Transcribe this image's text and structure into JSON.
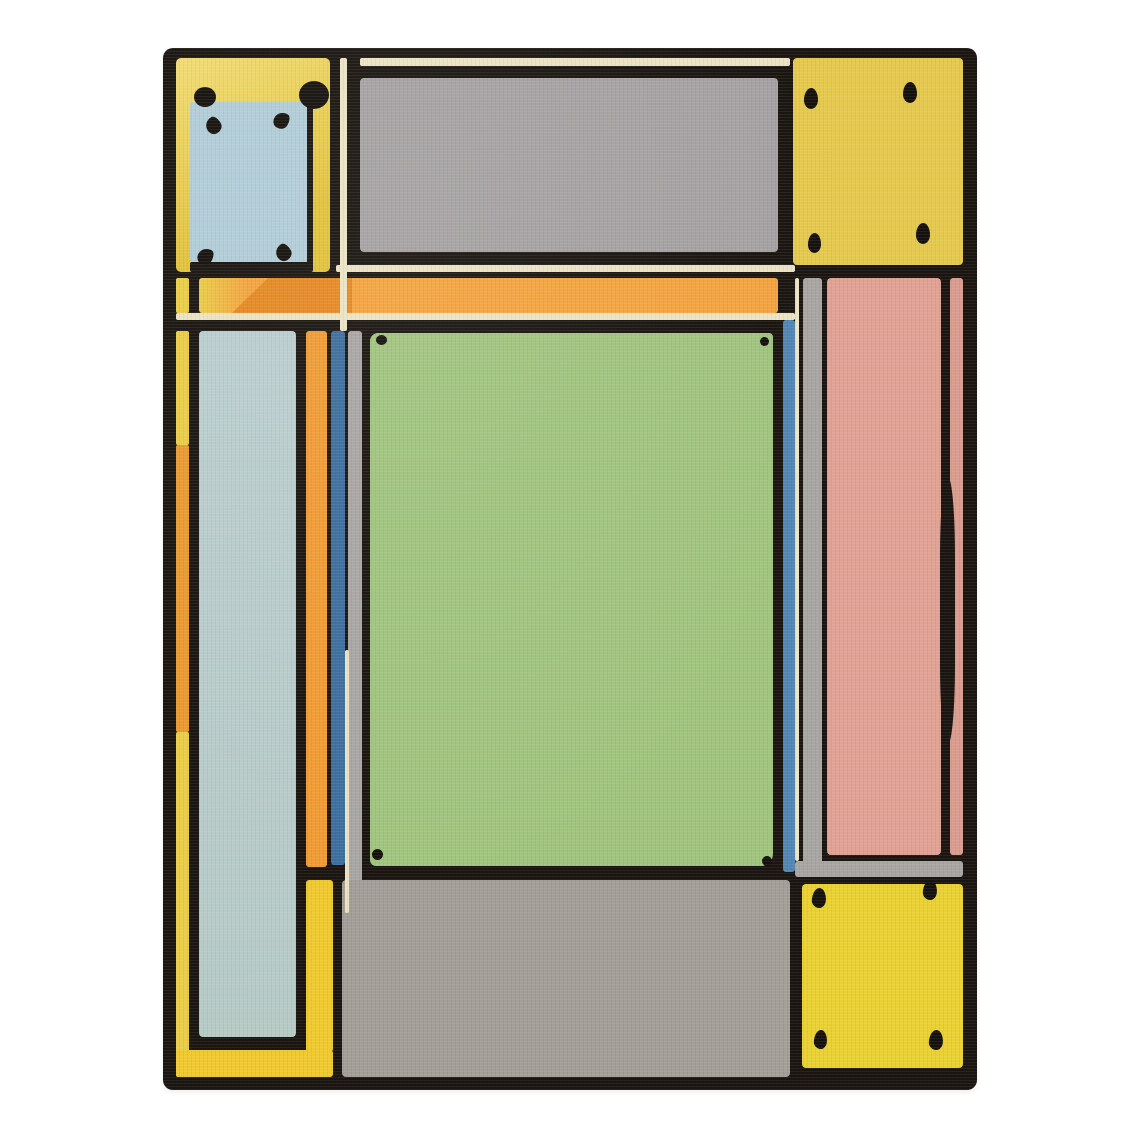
{
  "artwork": {
    "kind": "geometric patterned area rug photographed on a plain white background",
    "visible_text": "none"
  },
  "palette": {
    "page_background": "#ffffff",
    "outline_black": "#1a1510",
    "yellow_top_left_light": "#f1dc74",
    "yellow_top_left_deep": "#e2c23c",
    "yellow_top_right": "#e5c94f",
    "yellow_bottom_right": "#e9d134",
    "yellow_frame": "#eeca30",
    "yellow_edge_strip": "#eacd48",
    "orange_edge_segment": "#e99b31",
    "orange_band": "#f3a441",
    "orange_band_dark": "#e58a26",
    "orange_pillar": "#f09c36",
    "pale_blue_inset": "#b2cdd8",
    "pale_blue_column": "#bbcecf",
    "steel_blue_left": "#3f6f9e",
    "steel_blue_right": "#5286b3",
    "gray_top_panel": "#a6a2a3",
    "gray_strip": "#a9a6a5",
    "gray_right_band": "#a8a5a2",
    "gray_bottom_band": "#a39e97",
    "green_field": "#a1c47f",
    "pink_field": "#e0a294",
    "pink_sliver": "#d99c8f",
    "cream_line": "#ebe3c4",
    "dot_black": "#15110d"
  },
  "marks": {
    "top_left_large_dots": 2,
    "top_left_inset_corner_marks": 4,
    "top_right_corner_dots": 4,
    "green_corner_dots": 4,
    "bottom_right_corner_dots": 4
  },
  "regions": [
    {
      "name": "top-left-yellow-panel",
      "color": "yellow_top_left_deep"
    },
    {
      "name": "top-left-pale-blue-inset",
      "color": "pale_blue_inset"
    },
    {
      "name": "top-gray-panel",
      "color": "gray_top_panel"
    },
    {
      "name": "top-right-yellow-panel",
      "color": "yellow_top_right"
    },
    {
      "name": "orange-horizontal-band",
      "color": "orange_band"
    },
    {
      "name": "left-pale-blue-column",
      "color": "pale_blue_column"
    },
    {
      "name": "orange-pillar",
      "color": "orange_pillar"
    },
    {
      "name": "center-green-field",
      "color": "green_field"
    },
    {
      "name": "right-pink-column",
      "color": "pink_field"
    },
    {
      "name": "bottom-gray-band",
      "color": "gray_bottom_band"
    },
    {
      "name": "bottom-right-yellow-panel",
      "color": "yellow_bottom_right"
    },
    {
      "name": "bottom-left-yellow-frame",
      "color": "yellow_frame"
    }
  ]
}
